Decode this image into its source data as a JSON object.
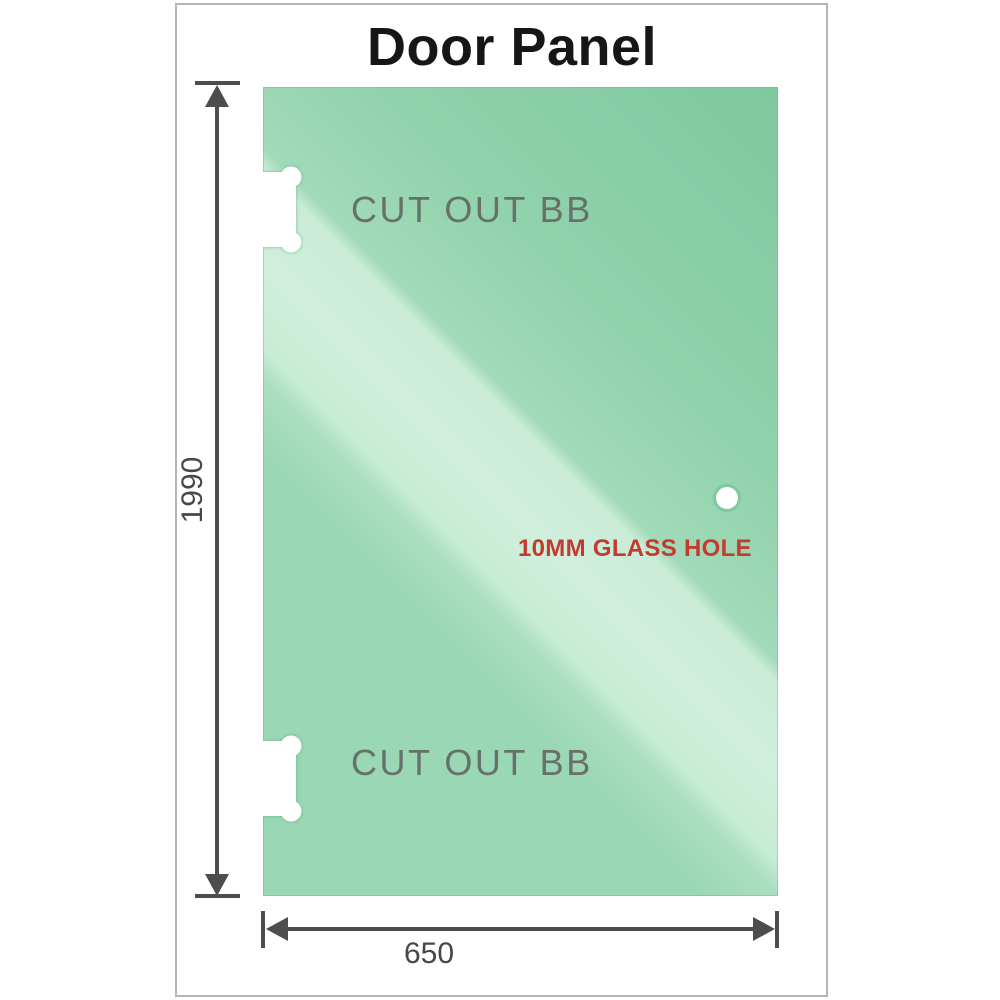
{
  "title": "Door Panel",
  "panel": {
    "cutout_top_label": "CUT OUT BB",
    "cutout_bottom_label": "CUT OUT BB",
    "hole_label": "10MM GLASS HOLE"
  },
  "dimensions": {
    "height_value": "1990",
    "width_value": "650"
  },
  "colors": {
    "glass_light": "#d0efdc",
    "glass_mid": "#9ad7b4",
    "glass_dark": "#80c89e",
    "frame_border": "#b3b6b8",
    "title_text": "#161616",
    "dimension": "#4d4d4d",
    "dim_text": "#474747",
    "cutout_label": "#68706b",
    "hole_label": "#c23b2d"
  }
}
